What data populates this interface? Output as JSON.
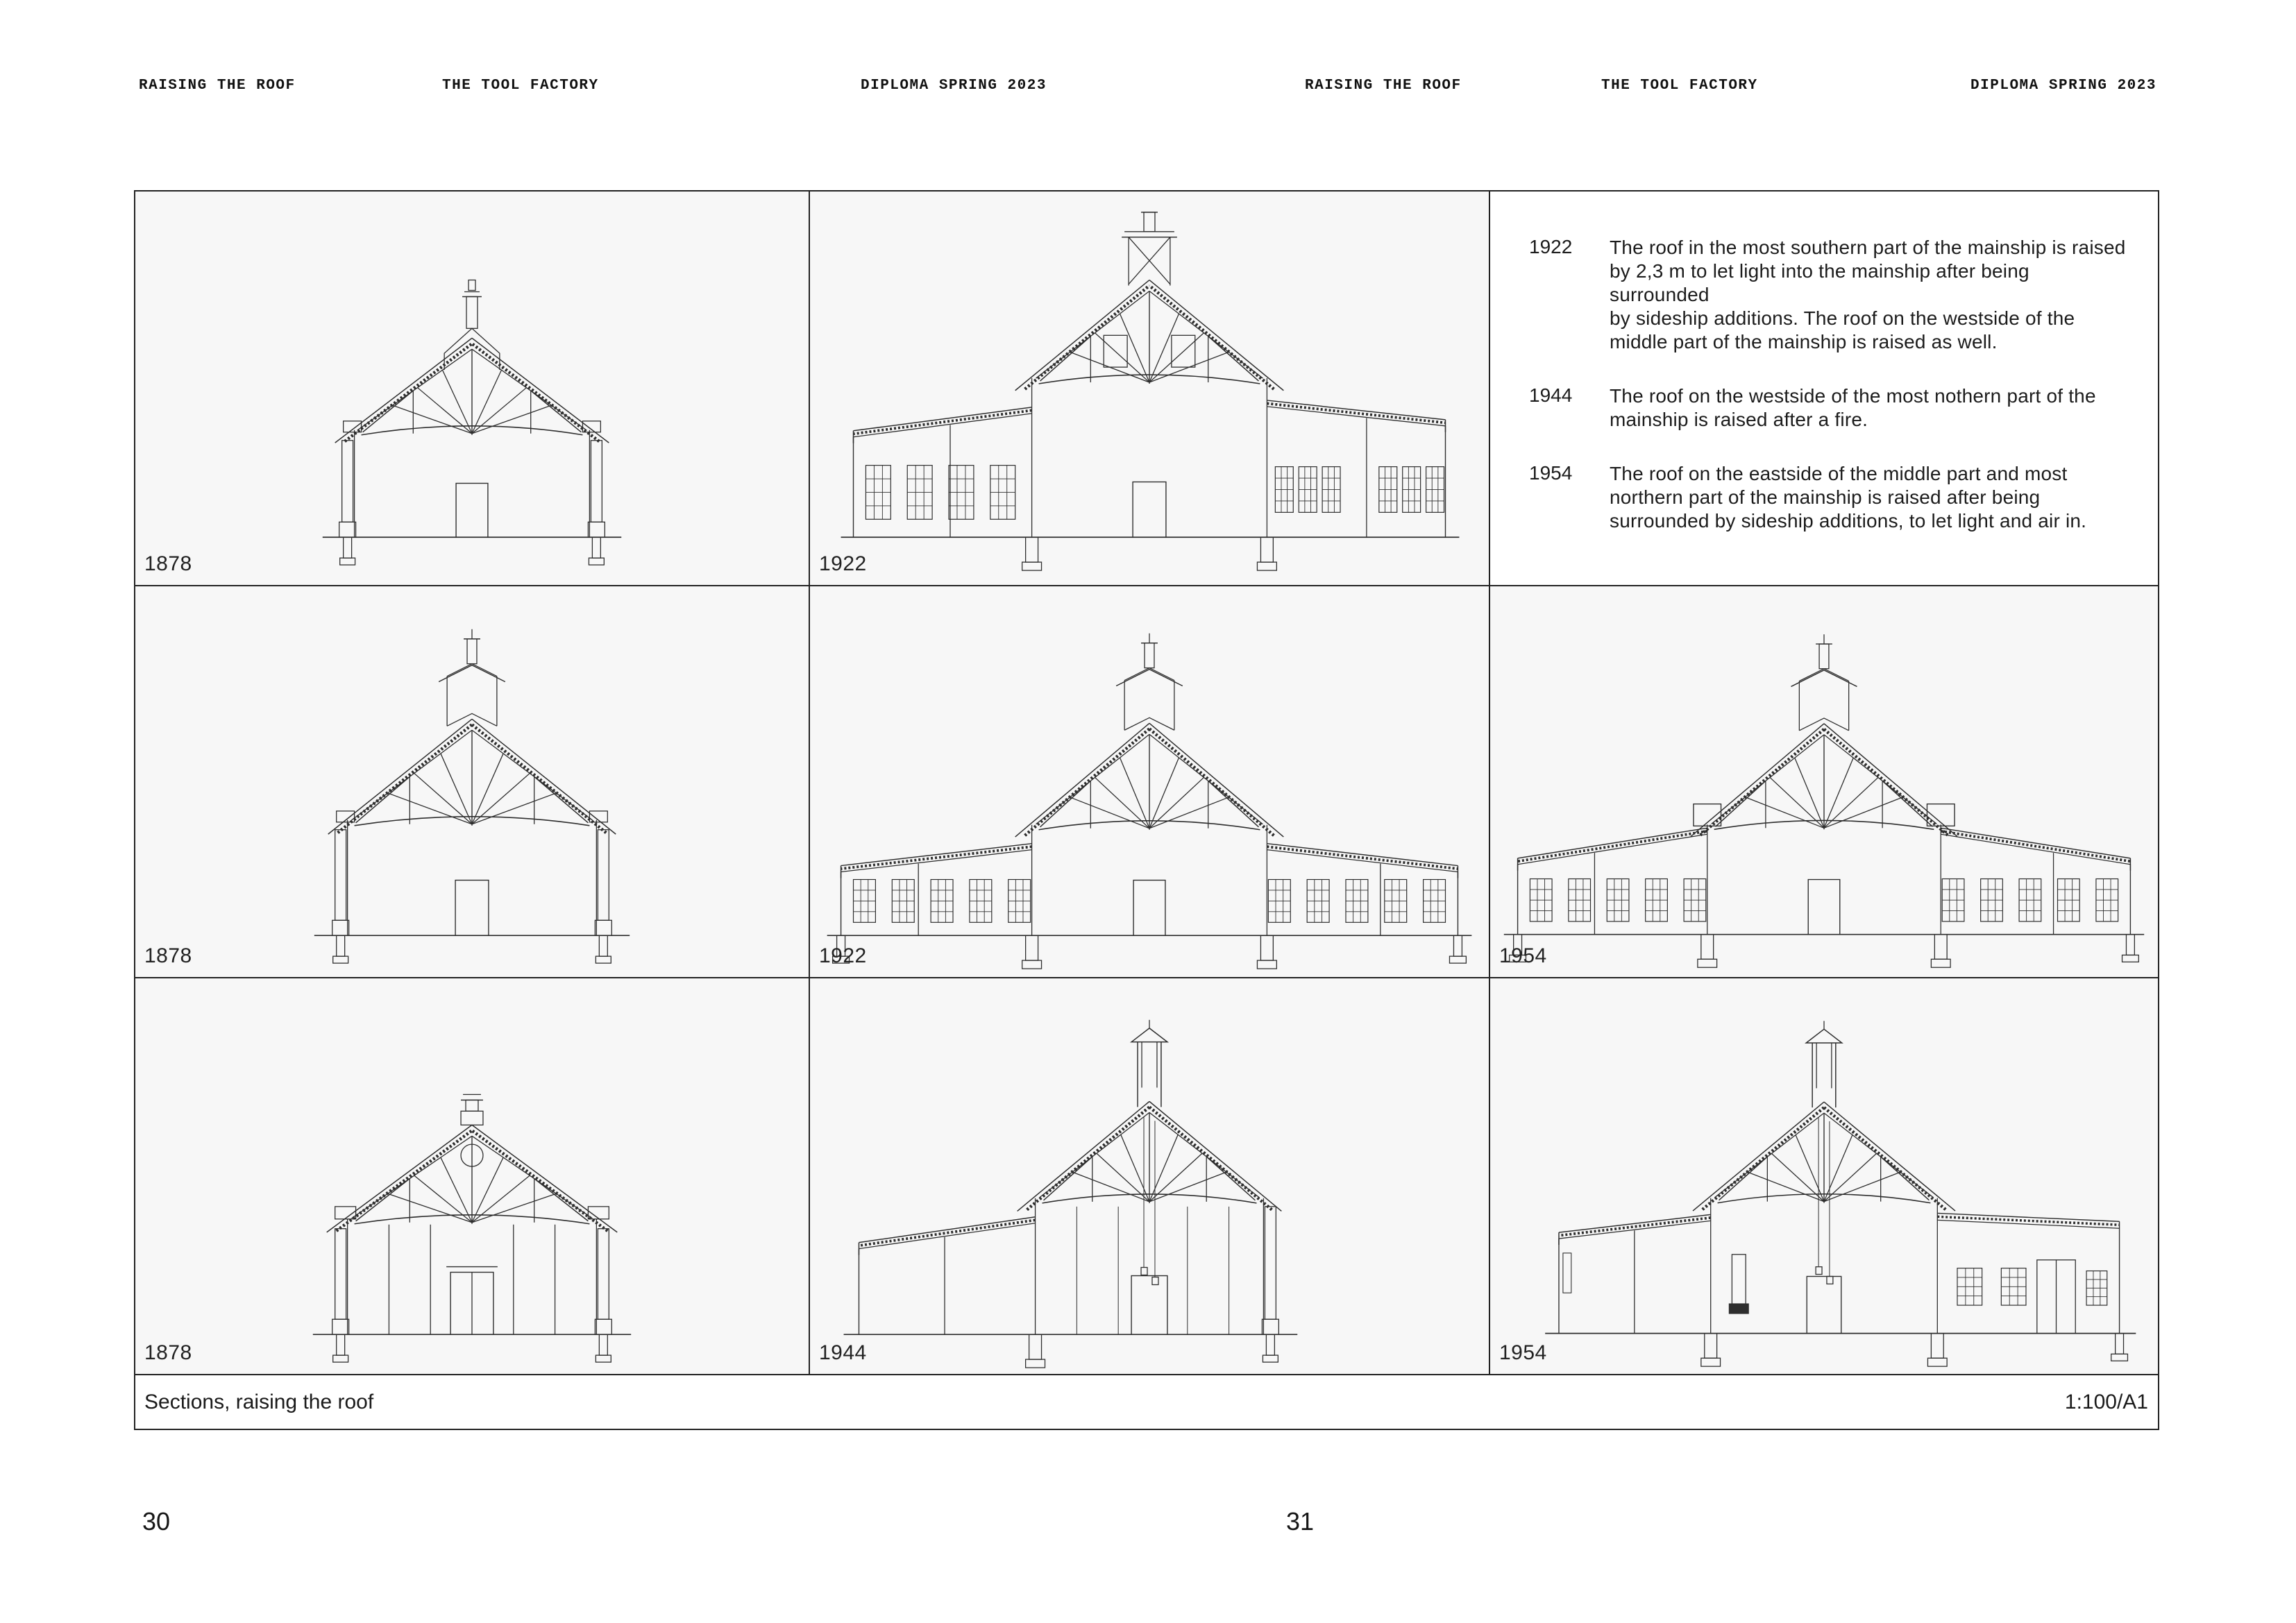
{
  "header": {
    "items": [
      "RAISING THE ROOF",
      "THE TOOL FACTORY",
      "DIPLOMA SPRING 2023"
    ]
  },
  "panels": {
    "r1c1": {
      "year": "1878"
    },
    "r1c2": {
      "year": "1922"
    },
    "r2c1": {
      "year": "1878"
    },
    "r2c2": {
      "year": "1922"
    },
    "r2c3": {
      "year": "1954"
    },
    "r3c1": {
      "year": "1878"
    },
    "r3c2": {
      "year": "1944"
    },
    "r3c3": {
      "year": "1954"
    }
  },
  "notes": {
    "entries": [
      {
        "year": "1922",
        "text": "The roof in the most southern part of the mainship is raised\nby 2,3 m to let light into the mainship after being surrounded\nby sideship additions. The roof on the westside of the\nmiddle part of the mainship is raised as well."
      },
      {
        "year": "1944",
        "text": "The roof on the westside of the most nothern part of the\nmainship is raised after a fire."
      },
      {
        "year": "1954",
        "text": "The roof on the eastside of the middle part and most\nnorthern part of the mainship is raised after being\nsurrounded by sideship additions, to let light and air in."
      }
    ]
  },
  "footer": {
    "title": "Sections, raising the roof",
    "scale": "1:100/A1"
  },
  "pages": {
    "left": "30",
    "right": "31"
  }
}
